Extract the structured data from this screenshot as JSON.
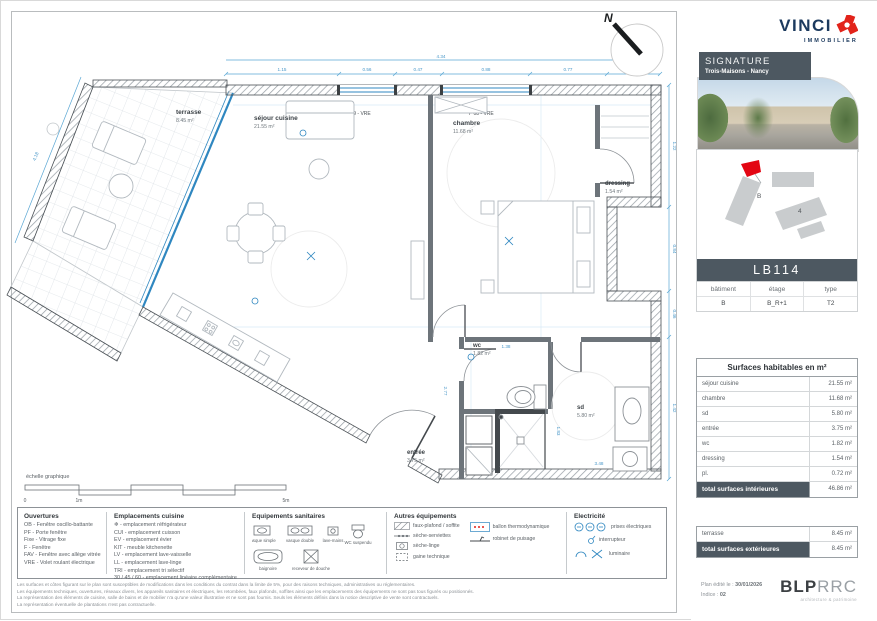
{
  "meta": {
    "compass": "N"
  },
  "plan": {
    "scale_label": "échelle graphique",
    "scale_ticks": [
      "0",
      "1m",
      "5m"
    ],
    "rooms": {
      "terrasse": {
        "name": "terrasse",
        "area": "8.45 m²"
      },
      "sejour": {
        "name": "séjour cuisine",
        "area": "21.55 m²"
      },
      "chambre": {
        "name": "chambre",
        "area": "11.68 m²"
      },
      "dressing": {
        "name": "dressing",
        "area": "1.54 m²"
      },
      "wc": {
        "name": "wc",
        "area": "1.82 m²"
      },
      "sd": {
        "name": "sd",
        "area": "5.80 m²"
      },
      "entree": {
        "name": "entrée",
        "area": "3.75 m²"
      }
    },
    "windows": {
      "sejour": "F 09 - VRE",
      "chambre": "F 08 - VRE"
    },
    "dims": {
      "d0": "4.34",
      "d1": "1.15",
      "d2": "0.56",
      "d3": "0.47",
      "d4": "0.88",
      "d5": "0.77",
      "d6": "0.53",
      "d7": "1.22",
      "d8": "0.84",
      "d9": "0.46",
      "d10": "1.42",
      "d11": "1.38",
      "d12": "2.77",
      "d13": "3.48",
      "d14": "1.83",
      "d15": "4.18"
    }
  },
  "legend": {
    "ouvertures": {
      "title": "Ouvertures",
      "items": [
        "OB - Fenêtre oscillo-battante",
        "PF - Porte fenêtre",
        "Fixe - Vitrage fixe",
        "F - Fenêtre",
        "FAV - Fenêtre avec allège vitrée",
        "VRE - Volet roulant électrique"
      ]
    },
    "cuisine": {
      "title": "Emplacements cuisine",
      "items": [
        "❄ - emplacement réfrigérateur",
        "CUI - emplacement cuisson",
        "EV - emplacement évier",
        "KIT - meuble kitchenette",
        "LV - emplacement lave-vaisselle",
        "LL - emplacement lave-linge",
        "TRI - emplacement tri sélectif",
        "30 / 45 / 60 - emplacement linéaire complémentaire"
      ]
    },
    "sanitaires": {
      "title": "Equipements sanitaires",
      "icons": [
        "vasque simple",
        "vasque double",
        "lave-mains",
        "WC suspendu",
        "baignoire",
        "receveur de douche"
      ]
    },
    "autres": {
      "title": "Autres équipements",
      "items": [
        "faux-plafond / soffite",
        "sèche-serviettes",
        "sèche-linge",
        "gaine technique"
      ],
      "items2": [
        "ballon thermodynamique",
        "robinet de puisage"
      ]
    },
    "electricite": {
      "title": "Electricité",
      "items": [
        "prises électriques",
        "interrupteur",
        "luminaire"
      ]
    }
  },
  "disclaimer": [
    "Les surfaces et côtes figurant sur le plan sont susceptibles de modifications dans les conditions du contrat dans la limite de 5%, pour des raisons techniques, administratives ou réglementaires.",
    "Les équipements techniques, ouvertures, réseaux divers, les appareils sanitaires et électriques, les retombées, faux plafonds, soffites ainsi que les emplacements des équipements ne sont pas tous figurés ou positionnés.",
    "La représentation des éléments de cuisine, salle de bains et de mobilier n'a qu'une valeur illustrative et ne sont pas fournis. Seuls les éléments définis dans la notice descriptive de vente sont contractuels.",
    "La représentation éventuelle de plantations n'est pas contractuelle."
  ],
  "sidebar": {
    "brand": {
      "name": "VINCI",
      "division": "IMMOBILIER"
    },
    "program": {
      "label": "SIGNATURE",
      "location": "Trois-Maisons - Nancy"
    },
    "siteplan": {
      "building_label": "B",
      "other_label": "4"
    },
    "unit_code": "LB114",
    "unit_info": {
      "headers": [
        "bâtiment",
        "étage",
        "type"
      ],
      "values": [
        "B",
        "B_R+1",
        "T2"
      ]
    },
    "surfaces_int": {
      "title": "Surfaces habitables en m²",
      "rows": [
        {
          "label": "séjour cuisine",
          "value": "21.55 m²"
        },
        {
          "label": "chambre",
          "value": "11.68 m²"
        },
        {
          "label": "sd",
          "value": "5.80 m²"
        },
        {
          "label": "entrée",
          "value": "3.75 m²"
        },
        {
          "label": "wc",
          "value": "1.82 m²"
        },
        {
          "label": "dressing",
          "value": "1.54 m²"
        },
        {
          "label": "pl.",
          "value": "0.72 m²"
        }
      ],
      "total_label": "total surfaces intérieures",
      "total_value": "46.86 m²"
    },
    "surfaces_ext": {
      "rows": [
        {
          "label": "terrasse",
          "value": "8.45 m²"
        }
      ],
      "total_label": "total surfaces extérieures",
      "total_value": "8.45 m²"
    },
    "footer": {
      "edited_label": "Plan édité le :",
      "edited_value": "30/01/2026",
      "index_label": "Indice :",
      "index_value": "02",
      "architect_bold": "BLP",
      "architect_thin": "RRC",
      "architect_tagline": "architecture & patrimoine"
    }
  }
}
